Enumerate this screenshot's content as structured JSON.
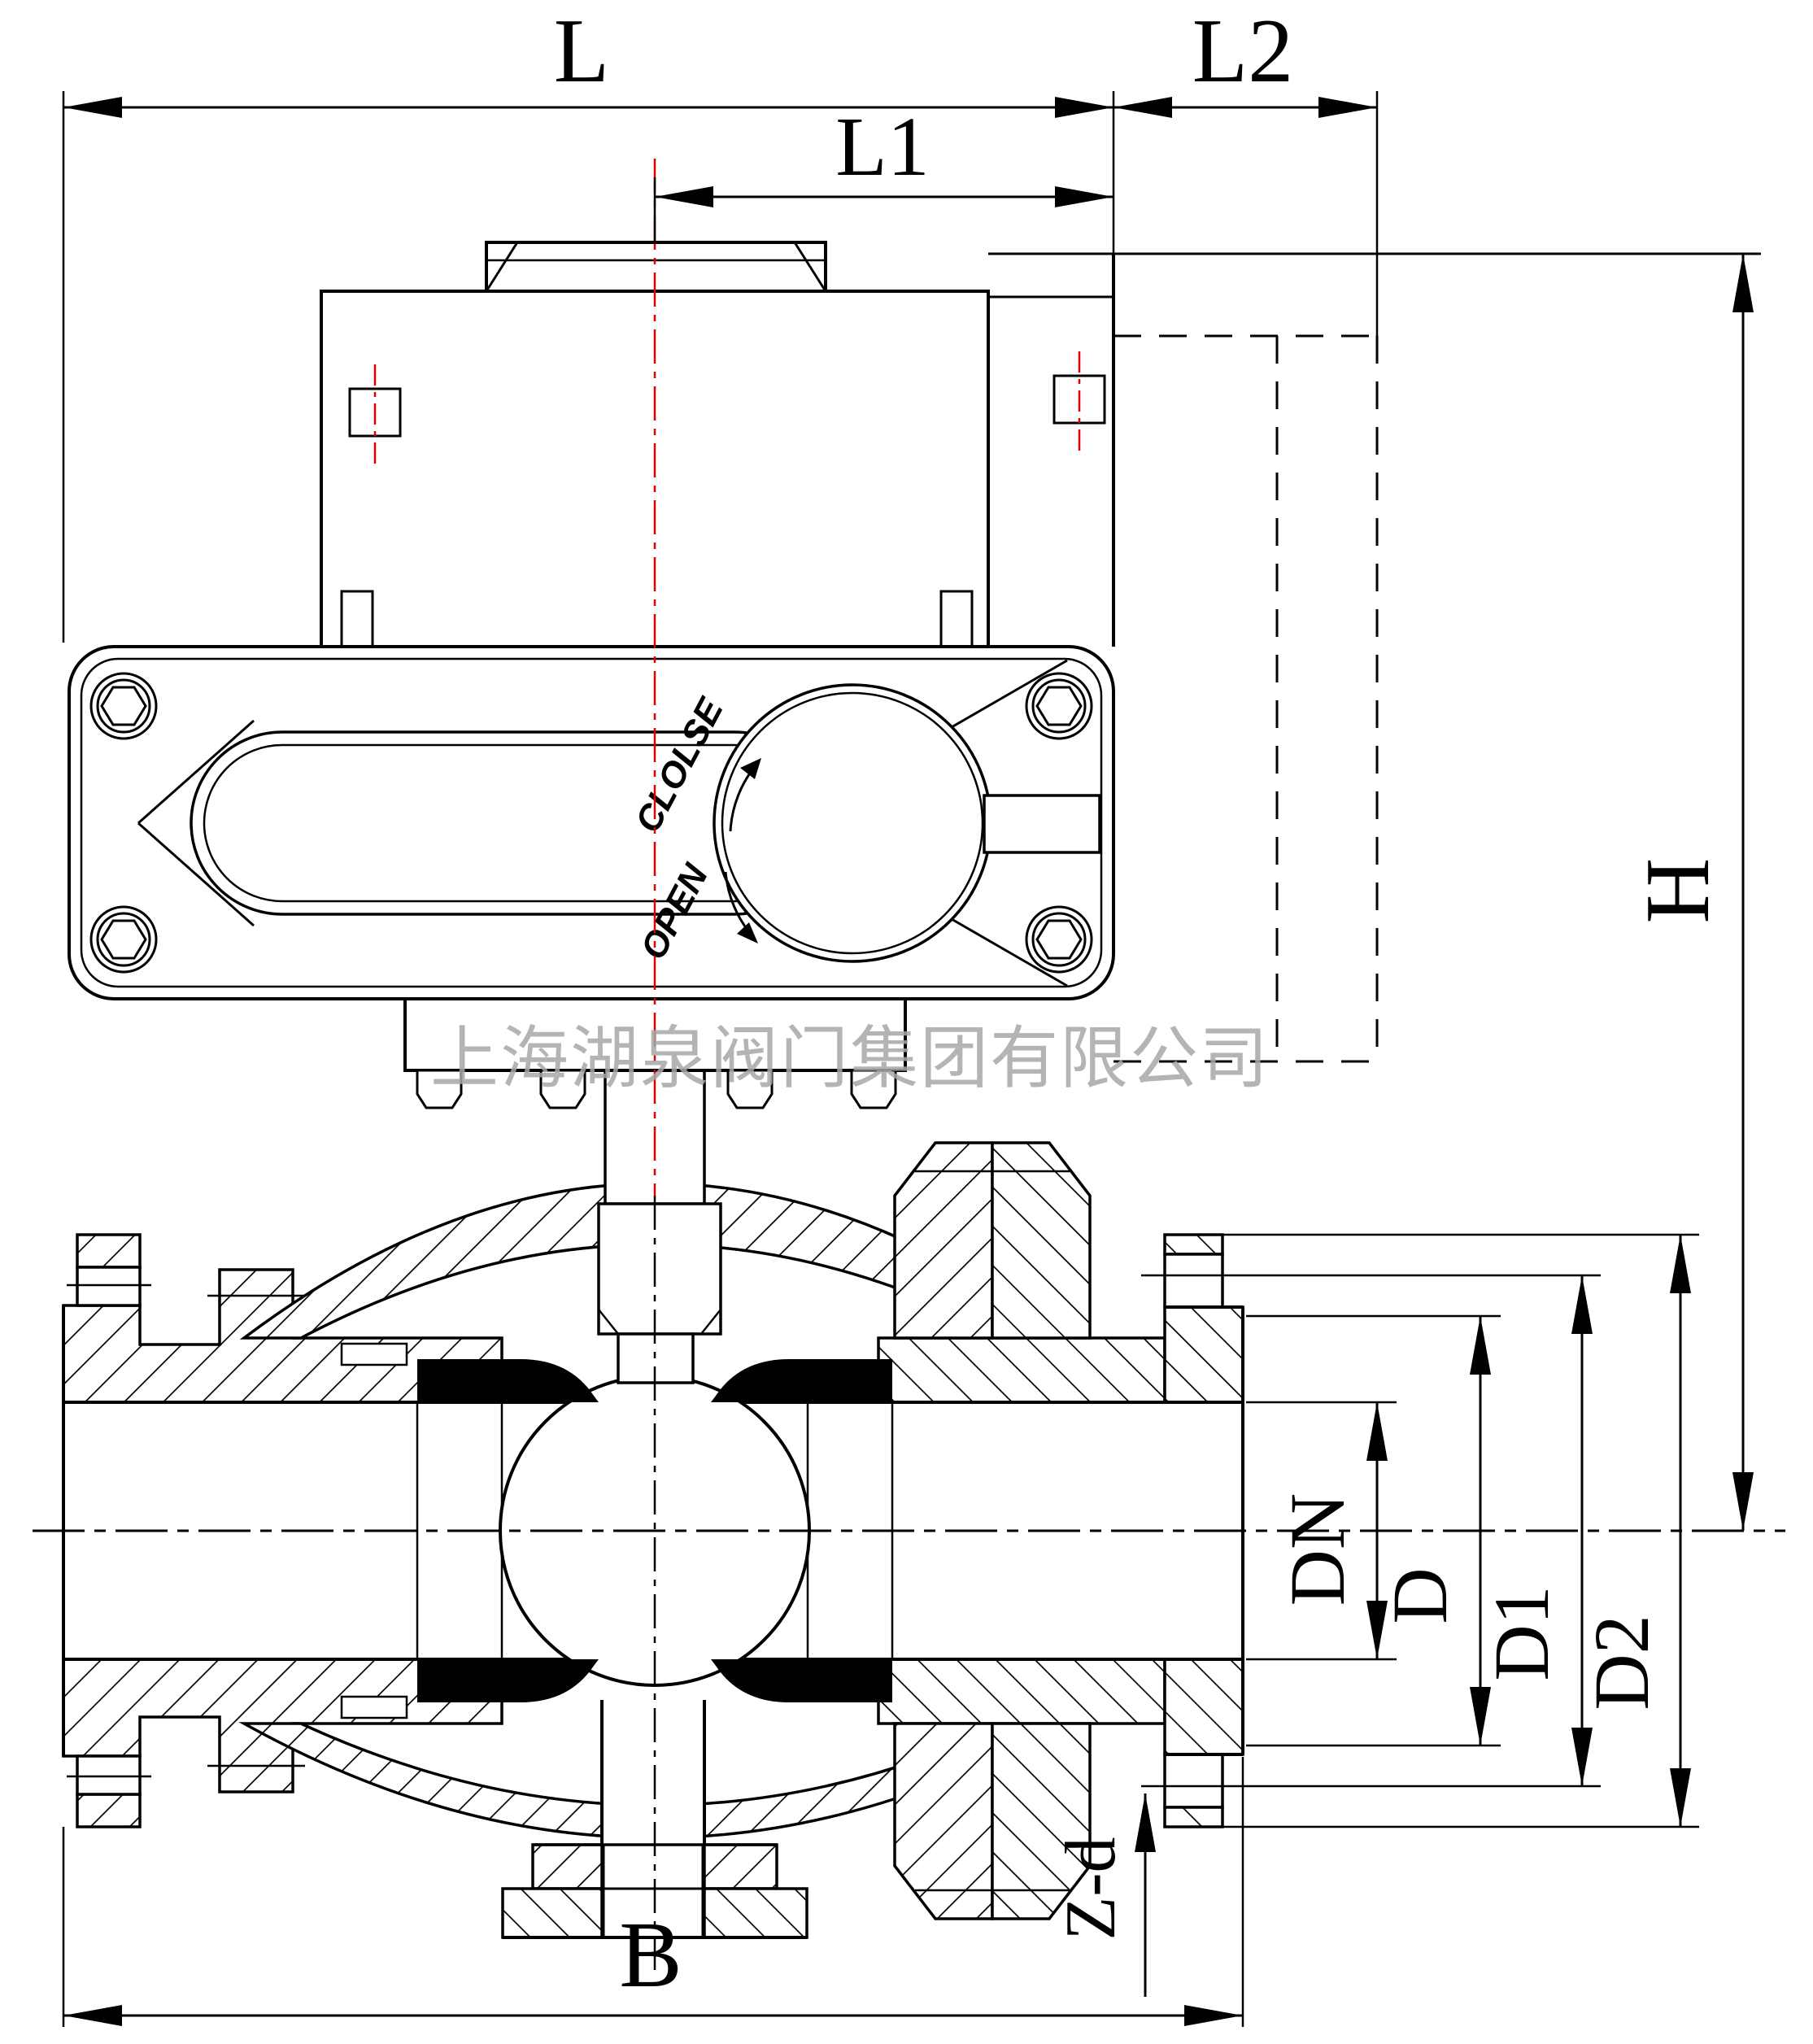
{
  "drawing": {
    "type": "valve-sectional-engineering-drawing",
    "watermark": "上海湖泉阀门集团有限公司",
    "actuator": {
      "close_label": "CLOLSE",
      "open_label": "OPEN"
    },
    "dims": {
      "L": "L",
      "L1": "L1",
      "L2": "L2",
      "H": "H",
      "B": "B",
      "DN": "DN",
      "D": "D",
      "D1": "D1",
      "D2": "D2",
      "Zd": "Z-d"
    },
    "colors": {
      "line": "#000000",
      "centerline_red": "#e00000",
      "watermark_gray": "#a8a8a8",
      "seat_black": "#000000",
      "background": "#ffffff"
    }
  }
}
